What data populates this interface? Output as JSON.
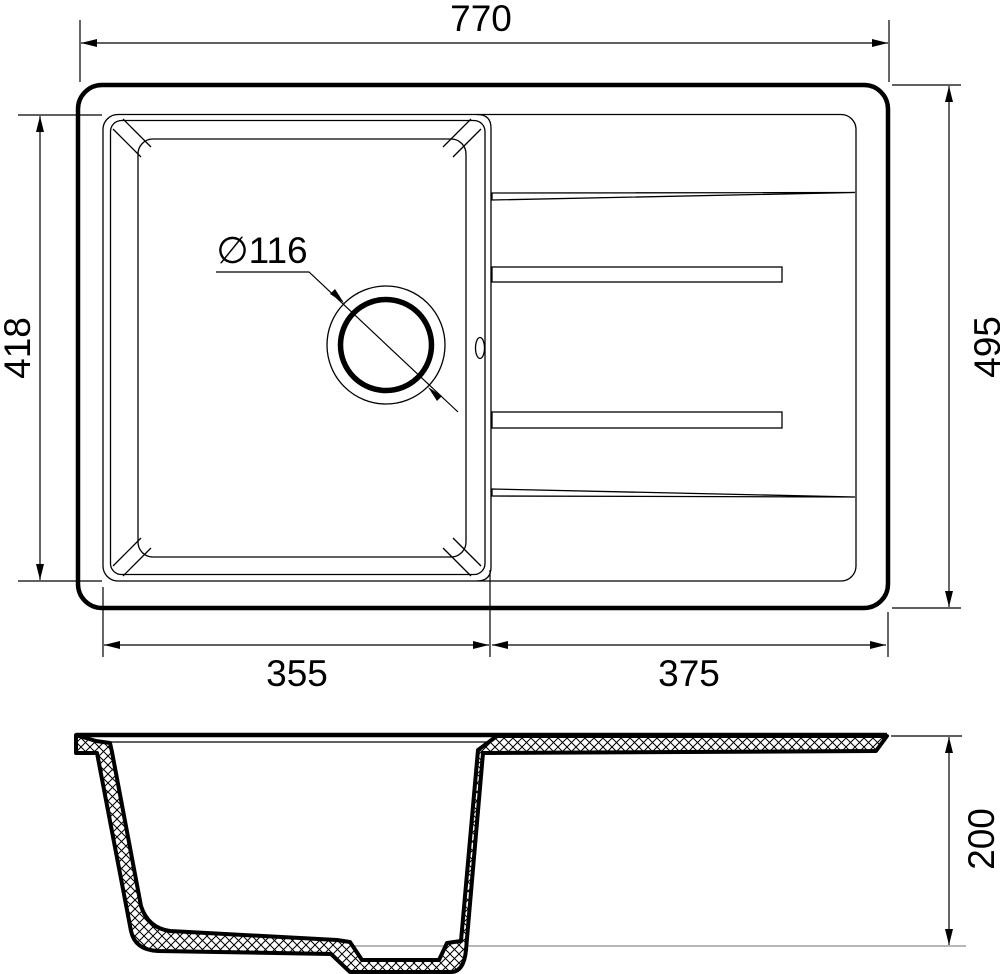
{
  "drawing": {
    "background": "#ffffff",
    "line_color": "#000000",
    "reference_line_color": "#8c8c8c",
    "views": {
      "top": {
        "name": "top view of sink with bowl and drainboard",
        "dims": {
          "overall_width": "770",
          "overall_depth": "495",
          "bowl_length": "418",
          "bowl_width": "355",
          "drainboard_width": "375",
          "drain_diameter": "∅116"
        }
      },
      "section": {
        "name": "cross section view",
        "dims": {
          "bowl_depth": "200"
        }
      }
    }
  }
}
